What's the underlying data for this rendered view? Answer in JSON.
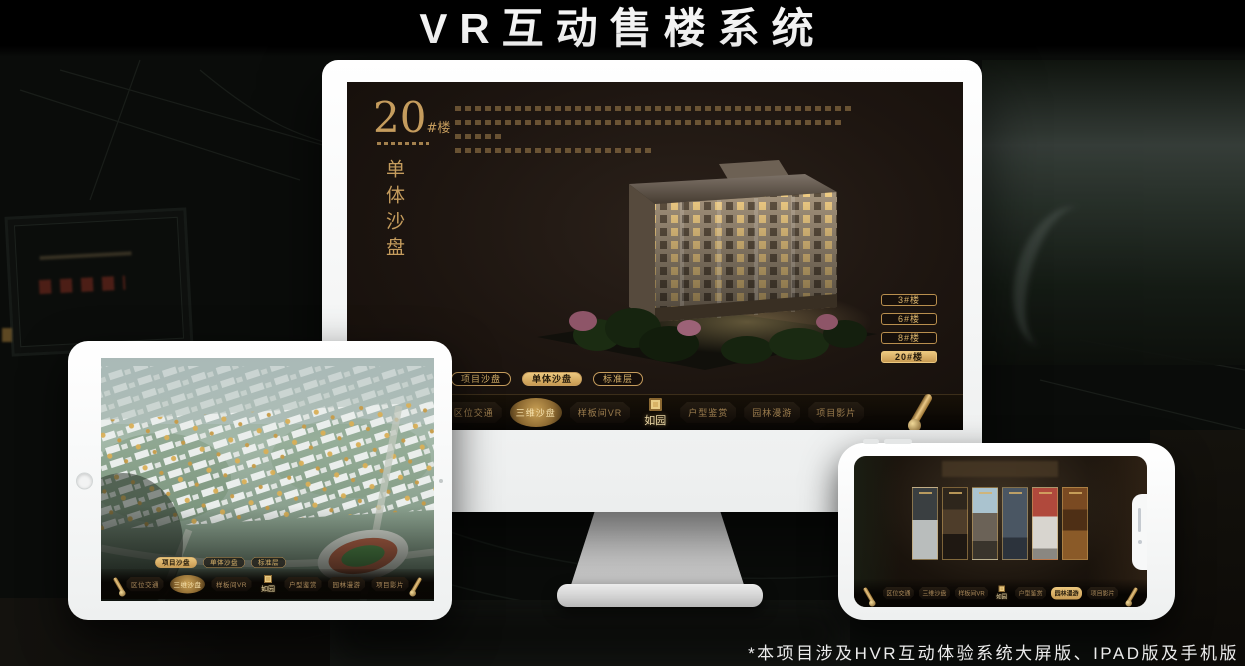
{
  "page": {
    "title": "VR互动售楼系统",
    "footnote": "*本项目涉及HVR互动体验系统大屏版、IPAD版及手机版"
  },
  "colors": {
    "gold": "#c59c5d",
    "gold_bright": "#ecc87f",
    "screen_background": "#1d1510",
    "selected_text": "#241a0b"
  },
  "desktop_app": {
    "headline": {
      "number": "20",
      "suffix": "#楼",
      "subtitle": "单体沙盘"
    },
    "building_buttons": [
      {
        "label": "3#楼",
        "selected": false
      },
      {
        "label": "6#楼",
        "selected": false
      },
      {
        "label": "8#楼",
        "selected": false
      },
      {
        "label": "20#楼",
        "selected": true
      }
    ],
    "tabs": [
      {
        "label": "项目沙盘",
        "selected": false
      },
      {
        "label": "单体沙盘",
        "selected": true
      },
      {
        "label": "标准层",
        "selected": false
      }
    ],
    "menu": [
      {
        "label": "区位交通",
        "selected": false
      },
      {
        "label": "三维沙盘",
        "selected": true
      },
      {
        "label": "样板间VR",
        "selected": false
      },
      {
        "label": "户型鉴赏",
        "selected": false
      },
      {
        "label": "园林漫游",
        "selected": false
      },
      {
        "label": "项目影片",
        "selected": false
      }
    ],
    "logo": "如园"
  },
  "tablet_app": {
    "tabs": [
      {
        "label": "项目沙盘",
        "selected": true
      },
      {
        "label": "单体沙盘",
        "selected": false
      },
      {
        "label": "标准层",
        "selected": false
      }
    ],
    "menu": [
      {
        "label": "区位交通",
        "selected": false
      },
      {
        "label": "三维沙盘",
        "selected": true
      },
      {
        "label": "样板间VR",
        "selected": false
      },
      {
        "label": "户型鉴赏",
        "selected": false
      },
      {
        "label": "园林漫游",
        "selected": false
      },
      {
        "label": "项目影片",
        "selected": false
      }
    ],
    "logo": "如园"
  },
  "phone_app": {
    "menu": [
      {
        "label": "区位交通",
        "selected": false
      },
      {
        "label": "三维沙盘",
        "selected": false
      },
      {
        "label": "样板间VR",
        "selected": false
      },
      {
        "label": "户型鉴赏",
        "selected": false
      },
      {
        "label": "园林漫游",
        "selected": true
      },
      {
        "label": "项目影片",
        "selected": false
      }
    ],
    "logo": "如园"
  }
}
